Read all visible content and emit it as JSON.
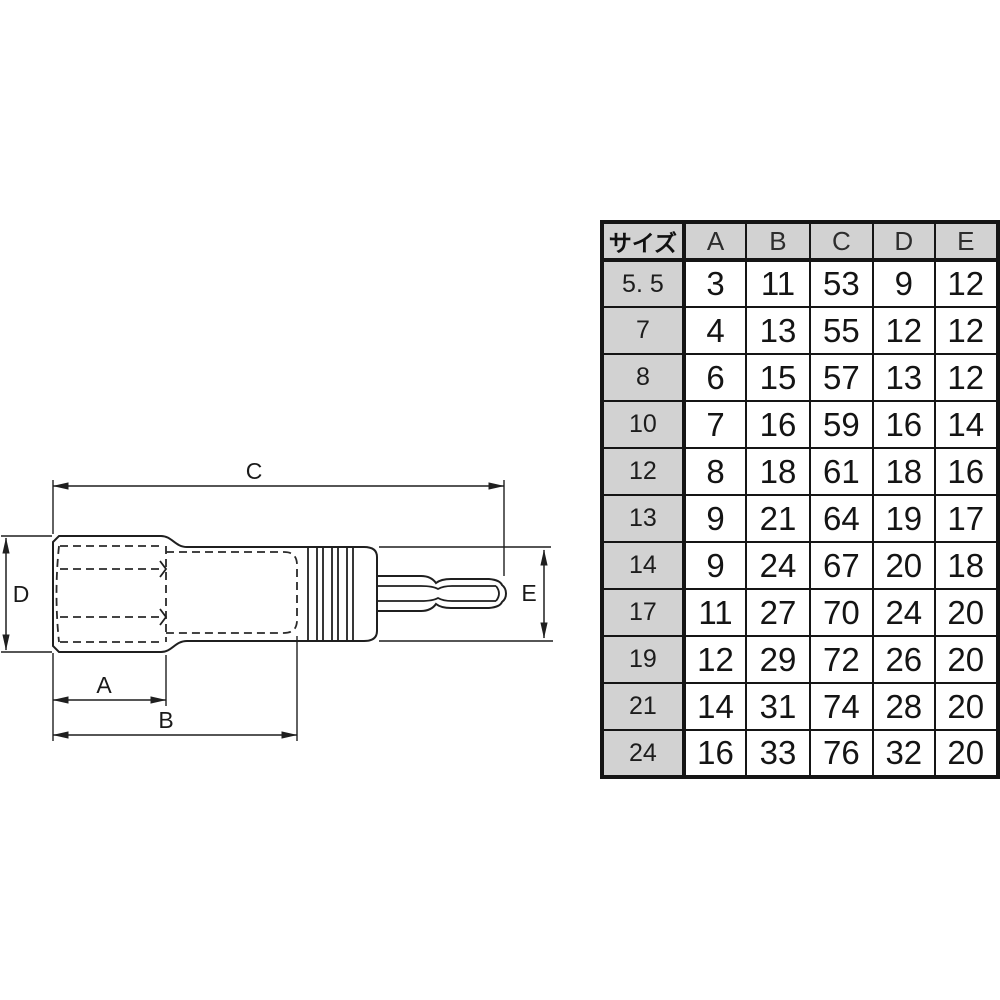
{
  "colors": {
    "line": "#1f1f1f",
    "table_border": "#151515",
    "table_header_bg": "#d2d2d2",
    "background": "#ffffff"
  },
  "diagram": {
    "description": "socket bit adapter side view with dimension callouts",
    "labels": {
      "a": "A",
      "b": "B",
      "c": "C",
      "d": "D",
      "e": "E"
    }
  },
  "table": {
    "size_header": "サイズ",
    "col_headers": [
      "A",
      "B",
      "C",
      "D",
      "E"
    ],
    "rows": [
      {
        "size": "5. 5",
        "a": "3",
        "b": "11",
        "c": "53",
        "d": "9",
        "e": "12"
      },
      {
        "size": "7",
        "a": "4",
        "b": "13",
        "c": "55",
        "d": "12",
        "e": "12"
      },
      {
        "size": "8",
        "a": "6",
        "b": "15",
        "c": "57",
        "d": "13",
        "e": "12"
      },
      {
        "size": "10",
        "a": "7",
        "b": "16",
        "c": "59",
        "d": "16",
        "e": "14"
      },
      {
        "size": "12",
        "a": "8",
        "b": "18",
        "c": "61",
        "d": "18",
        "e": "16"
      },
      {
        "size": "13",
        "a": "9",
        "b": "21",
        "c": "64",
        "d": "19",
        "e": "17"
      },
      {
        "size": "14",
        "a": "9",
        "b": "24",
        "c": "67",
        "d": "20",
        "e": "18"
      },
      {
        "size": "17",
        "a": "11",
        "b": "27",
        "c": "70",
        "d": "24",
        "e": "20"
      },
      {
        "size": "19",
        "a": "12",
        "b": "29",
        "c": "72",
        "d": "26",
        "e": "20"
      },
      {
        "size": "21",
        "a": "14",
        "b": "31",
        "c": "74",
        "d": "28",
        "e": "20"
      },
      {
        "size": "24",
        "a": "16",
        "b": "33",
        "c": "76",
        "d": "32",
        "e": "20"
      }
    ]
  }
}
